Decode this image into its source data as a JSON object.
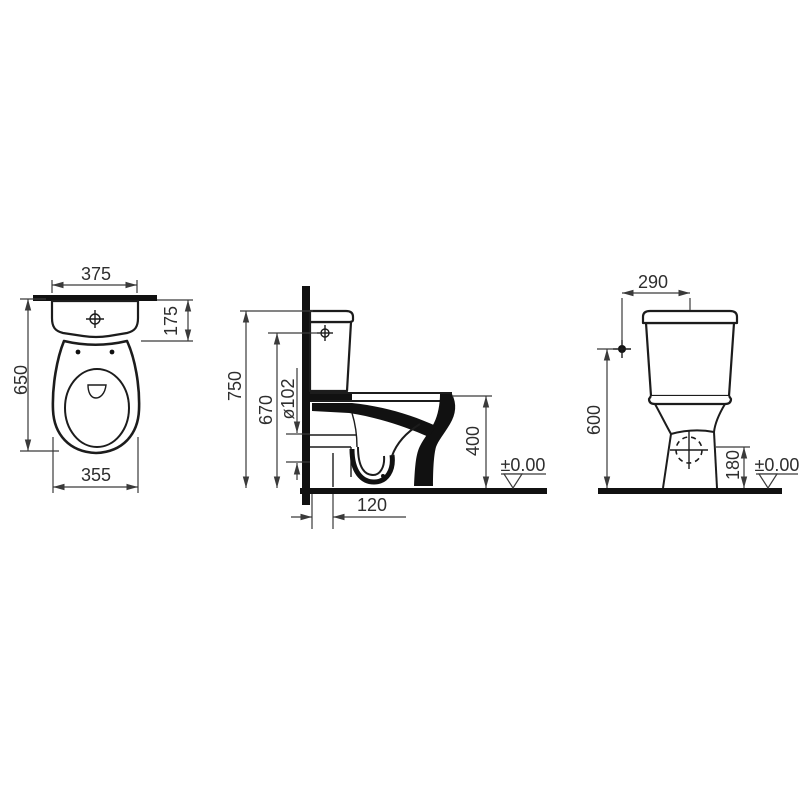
{
  "drawing": {
    "colors": {
      "background": "#ffffff",
      "line": "#1c1c1c",
      "dimension": "#3a3a3a"
    },
    "views": {
      "top_view": {
        "dim_tank_width": "375",
        "dim_tank_depth": "175",
        "dim_overall_depth": "650",
        "dim_bowl_width": "355"
      },
      "side_view": {
        "dim_overall_height": "750",
        "dim_inlet_height": "670",
        "dim_outlet_diameter": "ø102",
        "dim_rim_height": "400",
        "dim_outlet_distance": "120",
        "datum_level": "±0.00"
      },
      "rear_view": {
        "dim_inlet_offset": "290",
        "dim_inlet_height": "600",
        "dim_outlet_height": "180",
        "datum_level": "±0.00"
      }
    }
  }
}
